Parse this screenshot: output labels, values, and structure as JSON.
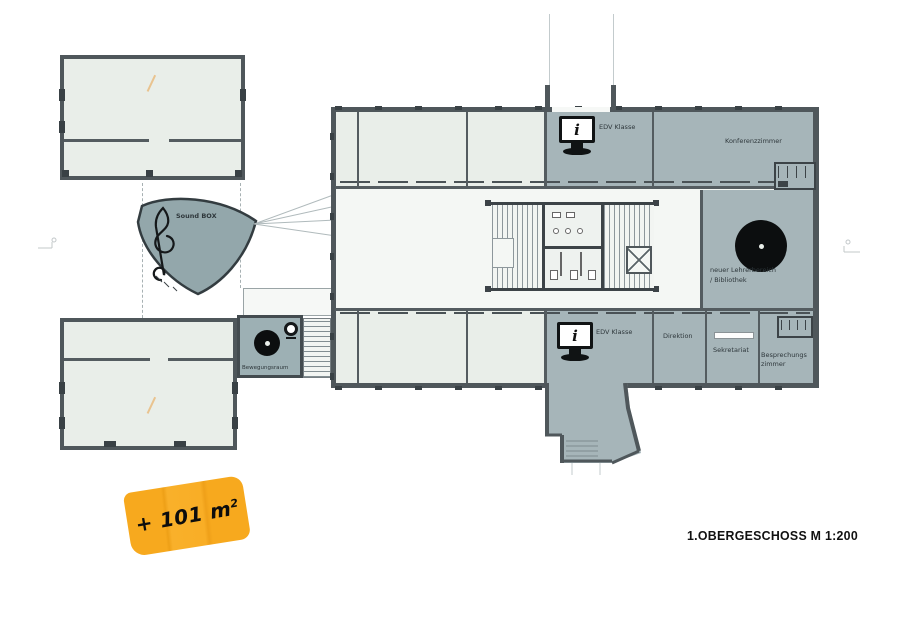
{
  "drawing": {
    "caption": "1.OBERGESCHOSS M 1:200",
    "badge": {
      "text": "+ 101 m",
      "sup": "2"
    },
    "labels": {
      "sound_box": "Sound BOX",
      "edv_klasse_top": "EDV Klasse",
      "konferenzzimmer": "Konferenzzimmer",
      "lehrerbereich_1": "neuer Lehrerbereich",
      "lehrerbereich_2": "/ Bibliothek",
      "edv_klasse_bottom": "EDV Klasse",
      "direktion": "Direktion",
      "sekretariat": "Sekretariat",
      "besprechung_1": "Besprechungs",
      "besprechung_2": "zimmer",
      "bewegungsraum": "Bewegungsraum"
    },
    "icons": {
      "monitor_char": "i"
    },
    "colors": {
      "room_teal": "#a6b5b9",
      "room_light": "#e9eee9",
      "wall": "#4f575b",
      "corridor": "#f4f7f4",
      "badge_orange": "#f7a91e"
    }
  }
}
